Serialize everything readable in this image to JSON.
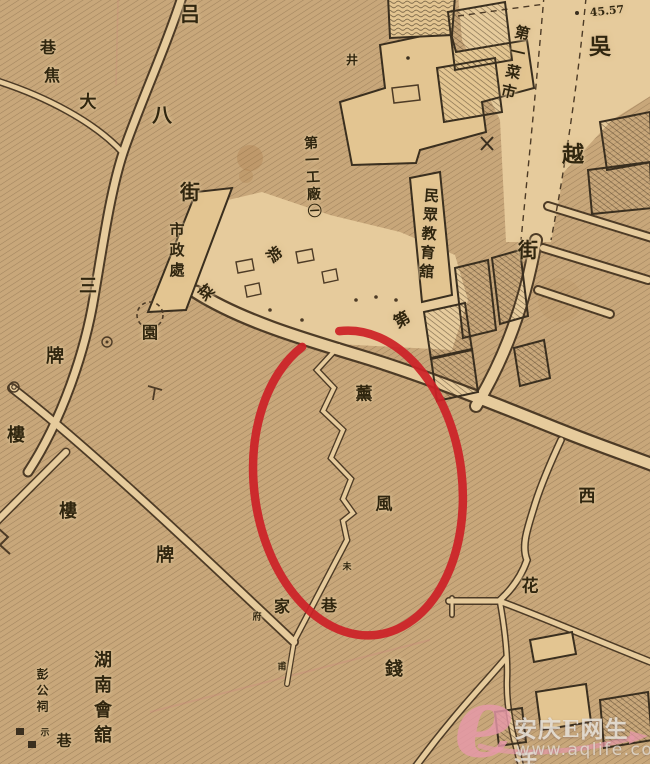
{
  "map": {
    "labels": {
      "lu": "吕",
      "xiang1": "巷",
      "jiao": "焦",
      "da": "大",
      "ba": "八",
      "jie1": "街",
      "san": "三",
      "pai1": "牌",
      "lou1": "樓",
      "lou2": "樓",
      "pai2": "牌",
      "shizhengchu": "市政處",
      "cai": "菜",
      "yuan": "園",
      "you": "游",
      "diyigongchang": "第一工廠㊀",
      "diyicaishi": "第一菜市",
      "wu": "吳",
      "yue": "越",
      "jie2": "街",
      "elevation": "45.57",
      "minzhongjiaoyuguan": "民眾教育舘",
      "di": "第",
      "xun": "薰",
      "feng": "風",
      "wei_small": "未",
      "jia": "家",
      "xiang2": "巷",
      "fu_small": "府",
      "pu_small": "甫",
      "qian": "錢",
      "hua": "花",
      "xi": "西",
      "hunanhuiguan": "湖南會舘",
      "penggongci": "彭公祠",
      "shi_small": "示",
      "xiang3": "巷",
      "well_mark": "井"
    },
    "annotation": {
      "type": "hand-drawn-ellipse",
      "color": "#cc2127"
    },
    "colors": {
      "paper": "#c8a77a",
      "road_fill": "#e6cb9c",
      "line_dark": "#4d3b26",
      "building_fill": "#e3c591",
      "red": "#cc2127"
    }
  },
  "watermark": {
    "logo": "e",
    "site_name": "安庆E网生活",
    "url": "www.aqlife.com",
    "pink": "#e89bac"
  }
}
